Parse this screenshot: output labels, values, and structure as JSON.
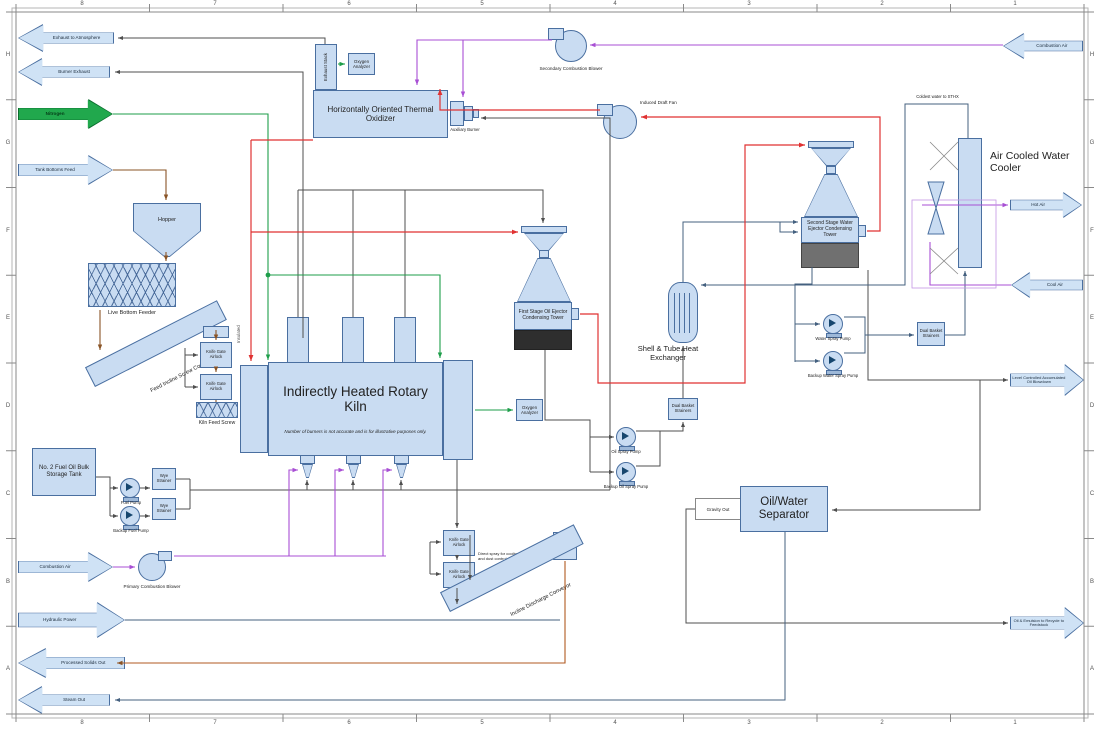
{
  "border": {
    "columns": [
      "8",
      "7",
      "6",
      "5",
      "4",
      "3",
      "2",
      "1"
    ],
    "rows": [
      "H",
      "G",
      "F",
      "E",
      "D",
      "C",
      "B",
      "A"
    ]
  },
  "flags": {
    "exhaust_to_atmosphere": "Exhaust to Atmosphere",
    "burner_exhaust": "Burner Exhaust",
    "nitrogen": "Nitrogen",
    "tank_bottoms_feed": "Tank Bottoms Feed",
    "combustion_air_left": "Combustion Air",
    "hydraulic_power": "Hydraulic Power",
    "processed_solids_out": "Processed Solids Out",
    "steam_out": "Steam Out",
    "combustion_air_right": "Combustion Air",
    "hot_air": "Hot Air",
    "cool_air": "Cool Air",
    "oil_blowdown": "Level Controlled Accumulated Oil Blowdown",
    "oil_emulsion_recycle": "Oil & Emulsion to Recycle to Feedstock"
  },
  "equipment": {
    "exhaust_stack": "Exhaust Stack",
    "oxygen_analyzer": "Oxygen Analyzer",
    "thermal_oxidizer": "Horizontally Oriented Thermal Oxidizer",
    "auxiliary_burner": "Auxiliary Burner",
    "secondary_combustion_blower": "Secondary Combustion Blower",
    "induced_draft_fan": "Induced Draft Fan",
    "hopper": "Hopper",
    "live_bottom_feeder": "Live Bottom Feeder",
    "feed_incline_screw_conveyor": "Feed Incline Screw Conveyor",
    "knife_gate_airlock": "Knife Gate Airlock",
    "kiln_feed_screw": "Kiln Feed Screw",
    "rotary_kiln": "Indirectly Heated Rotary Kiln",
    "first_stage_tower": "First Stage Oil Ejector Condensing Tower",
    "second_stage_tower": "Second Stage Water Ejector Condensing Tower",
    "shell_tube_heat_exchanger": "Shell & Tube Heat Exchanger",
    "air_cooled_water_cooler": "Air Cooled Water Cooler",
    "water_spray_pump": "Water Spray Pump",
    "backup_water_spray_pump": "Backup Water Spray Pump",
    "dual_basket_strainers": "Dual Basket Strainers",
    "oil_spray_pump": "Oil Spray Pump",
    "backup_oil_spray_pump": "Backup Oil Spray Pump",
    "oil_water_separator": "Oil/Water Separator",
    "fuel_tank": "No. 2 Fuel Oil Bulk Storage Tank",
    "fuel_pump": "Fuel Pump",
    "backup_fuel_pump": "Backup Fuel Pump",
    "wye_strainer": "Wye Strainer",
    "primary_combustion_blower": "Primary Combustion Blower",
    "incline_discharge_conveyor": "Incline Discharge Conveyor"
  },
  "notes": {
    "kiln_note": "Number of burners is not accurate and is for illustrative purposes only.",
    "insulated": "Insulated",
    "coldest_water": "Coldest water to STHX",
    "direct_spray": "Direct spray for cooling and dust control",
    "gravity_out": "Gravity Out"
  },
  "colors": {
    "equipment_fill": "#c9dcf2",
    "equipment_border": "#4a6fa0",
    "nitrogen_green": "#21a84d",
    "line_red": "#e03232",
    "line_green": "#1e9e4a",
    "line_purple": "#a84fd4",
    "line_brown": "#8a5426",
    "line_black": "#4f4f4f",
    "tank_dark": "#2e2e2e",
    "tank_gray": "#707070"
  }
}
